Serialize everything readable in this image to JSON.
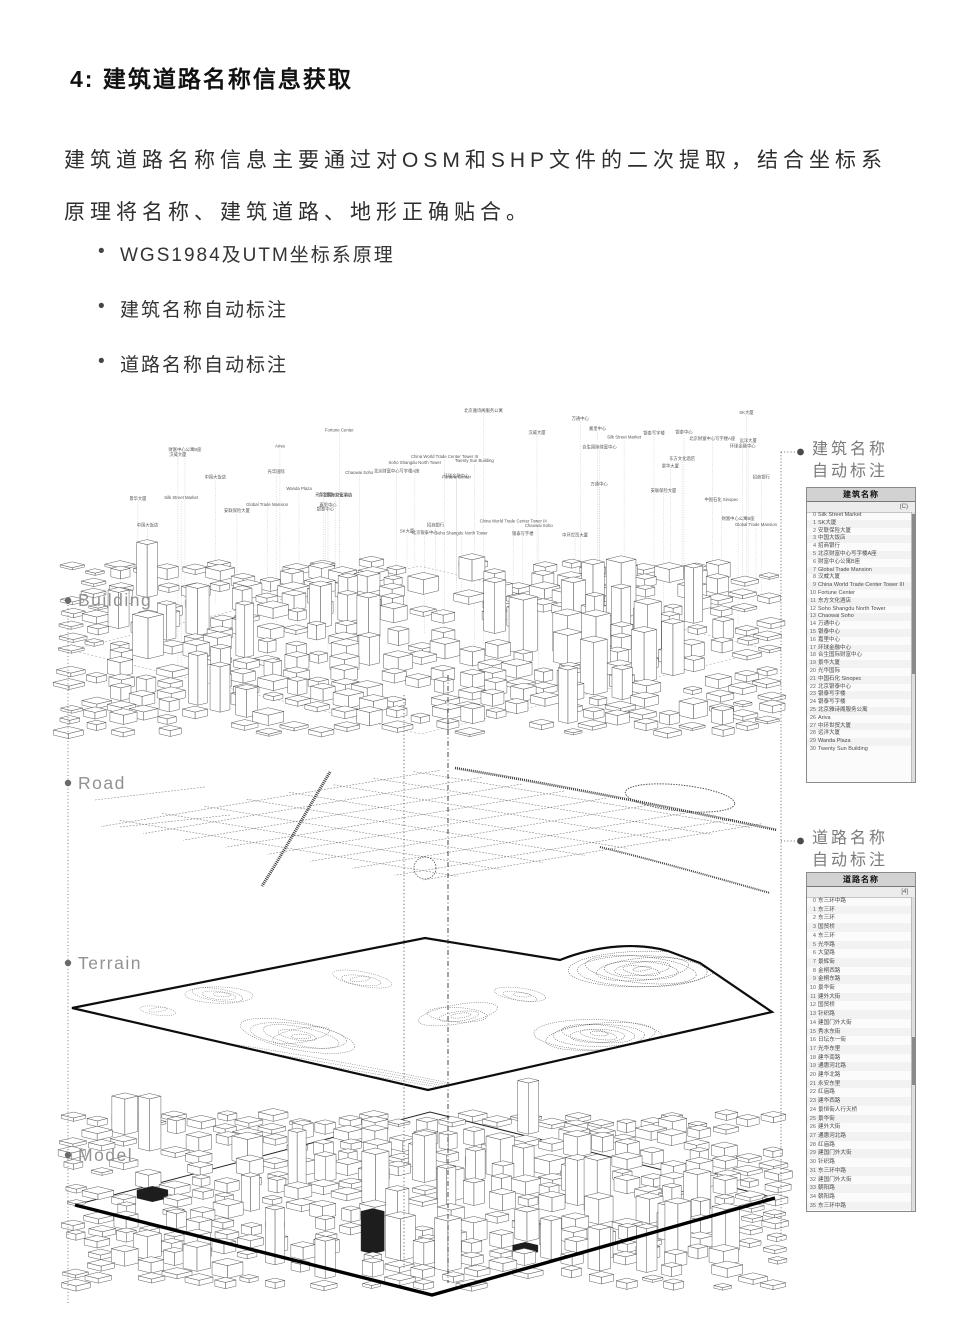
{
  "title": "4: 建筑道路名称信息获取",
  "intro": "建筑道路名称信息主要通过对OSM和SHP文件的二次提取，结合坐标系原理将名称、建筑道路、地形正确贴合。",
  "bullets": [
    "WGS1984及UTM坐标系原理",
    "建筑名称自动标注",
    "道路名称自动标注"
  ],
  "layers": [
    {
      "label": "Building"
    },
    {
      "label": "Road"
    },
    {
      "label": "Terrain"
    },
    {
      "label": "Model"
    }
  ],
  "annotations": {
    "building": {
      "line1": "建筑名称",
      "line2": "自动标注"
    },
    "road": {
      "line1": "道路名称",
      "line2": "自动标注"
    }
  },
  "building_panel": {
    "title": "建筑名称",
    "count_label": "(C)",
    "items": [
      "Silk Street Market",
      "SK大厦",
      "安联保险大厦",
      "中国大饭店",
      "招商银行",
      "北京财富中心写字楼A座",
      "财富中心公寓B座",
      "Global Trade Mansion",
      "汉威大厦",
      "China World Trade Center Tower III",
      "Fortune Center",
      "东方文化酒店",
      "Soho Shangdu North Tower",
      "Chaowai Soho",
      "万通中心",
      "银泰中心",
      "嘉里中心",
      "环球金融中心",
      "合生国际财富中心",
      "景华大厦",
      "光华国际",
      "中国石化 Sinopec",
      "北京银泰中心",
      "银泰写字楼",
      "银泰写字楼",
      "北京雅诗阁服务公寓",
      "Ariva",
      "中环世贸大厦",
      "远洋大厦",
      "Wanda Plaza",
      "Twenty Sun Building"
    ]
  },
  "road_panel": {
    "title": "道路名称",
    "count_label": "[4]",
    "items": [
      "东三环中路",
      "东三环",
      "东三环",
      "国贸桥",
      "东三环",
      "光华路",
      "大望路",
      "景辉街",
      "金桐西路",
      "金桐东路",
      "景华街",
      "建外大街",
      "国贸桥",
      "针织路",
      "建国门外大街",
      "秀水东街",
      "日坛东一街",
      "光华东里",
      "建华南路",
      "通惠河北路",
      "建华北路",
      "永安东里",
      "红庙路",
      "建华西路",
      "景恒街人行天桥",
      "景华街",
      "建外大街",
      "通惠河北路",
      "红庙路",
      "建国门外大街",
      "针织路",
      "东三环中路",
      "建国门外大街",
      "朝阳路",
      "朝阳路",
      "东三环中路"
    ]
  },
  "colors": {
    "accent_gray": "#919191",
    "line_dark": "#333333",
    "panel_header_bg": "#d2d2d2"
  }
}
